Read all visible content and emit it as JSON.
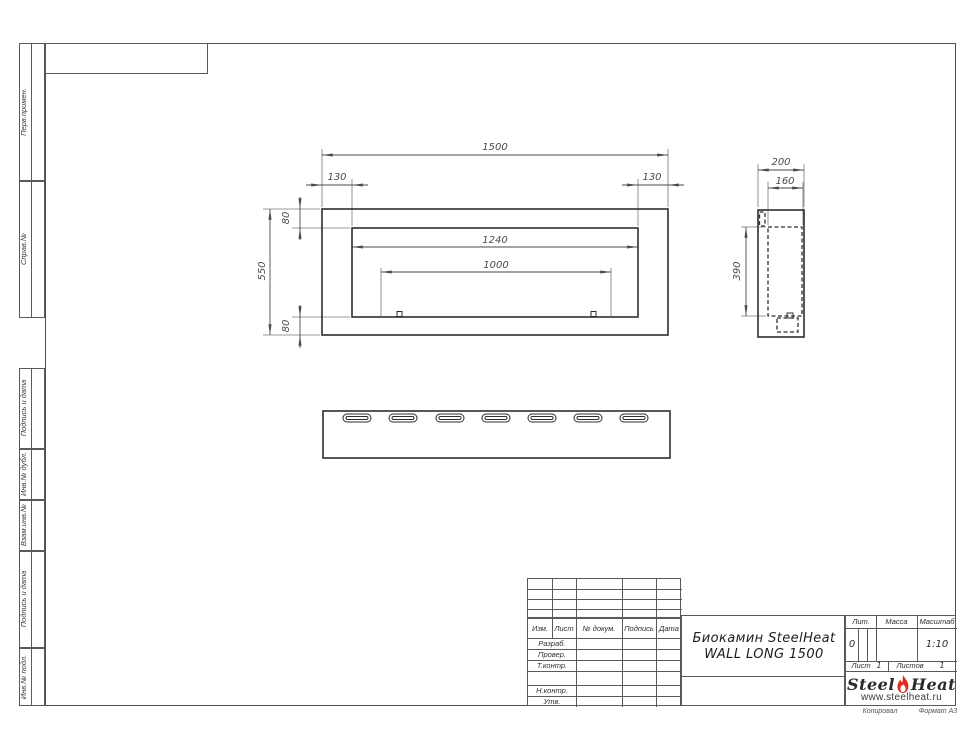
{
  "sheet": {
    "margin_labels": {
      "perv_primen": "Перв.примен.",
      "sprav_no": "Справ.№",
      "podpis_data_1": "Подпись и дата",
      "inv_dubl": "Инв.№ дубл.",
      "vzam_inv": "Взам.инв.№",
      "podpis_data_2": "Подпись и дата",
      "inv_podl": "Инв.№ подл."
    },
    "footer": {
      "kopiroval": "Копировал",
      "format": "Формат А3"
    }
  },
  "dims": {
    "front_width": "1500",
    "front_offset_left": "130",
    "front_offset_right": "130",
    "front_height": "550",
    "front_inset_top": "80",
    "front_inset_bottom": "80",
    "opening_width": "1240",
    "burner_width": "1000",
    "side_depth": "200",
    "side_inner_depth": "160",
    "side_opening_height": "390"
  },
  "title_block": {
    "cols": {
      "izm": "Изм.",
      "list": "Лист",
      "doc": "№ докум.",
      "podpis": "Подпись",
      "data": "Дата"
    },
    "rows": {
      "razrab": "Разраб.",
      "prover": "Провер.",
      "tkontr": "Т.контр.",
      "nkontr": "Н.контр.",
      "utv": "Утв."
    },
    "title_line1": "Биокамин SteelHeat",
    "title_line2": "WALL LONG 1500",
    "lit_label": "Лит.",
    "lit_value": "0",
    "massa_label": "Масса",
    "masshtab_label": "Масштаб",
    "masshtab_value": "1:10",
    "list_label": "Лист",
    "list_value": "1",
    "listov_label": "Листов",
    "listov_value": "1"
  },
  "logo": {
    "steel": "Steel",
    "heat": "Heat",
    "site": "www.steelheat.ru",
    "flame_red": "#e02a1f",
    "flame_orange": "#f59d00"
  }
}
